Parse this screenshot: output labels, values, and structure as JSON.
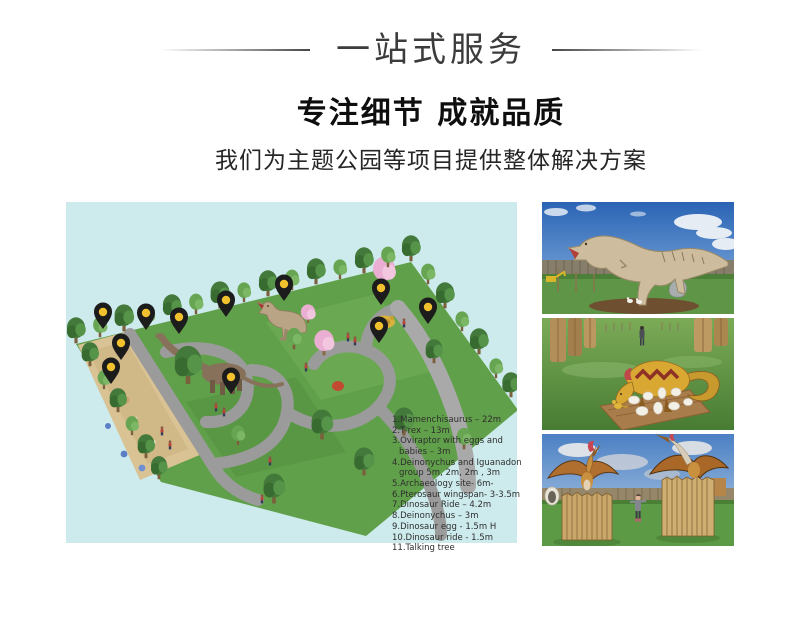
{
  "header": {
    "title": "一站式服务",
    "heading": "专注细节 成就品质",
    "subheading": "我们为主题公园等项目提供整体解决方案"
  },
  "map": {
    "legend": [
      "1.Mamenchisaurus – 22m",
      "2.T-rex – 13m",
      "3.Oviraptor with eggs and babies – 3m",
      "4.Deinonychus and Iguanadon group 5m, 2m, 2m , 3m",
      "5.Archaeology site- 6m-",
      "6.Pterosaur  wingspan- 3-3.5m",
      "7.Dinosaur Ride – 4.2m",
      "8.Deinonychus – 3m",
      "9.Dinosaur egg - 1.5m H",
      "10.Dinosaur ride -  1.5m",
      "11.Talking tree"
    ]
  },
  "colors": {
    "map_background": "#cdeaec",
    "pin_body": "#1c1c1c",
    "pin_dot": "#f2c12e"
  }
}
